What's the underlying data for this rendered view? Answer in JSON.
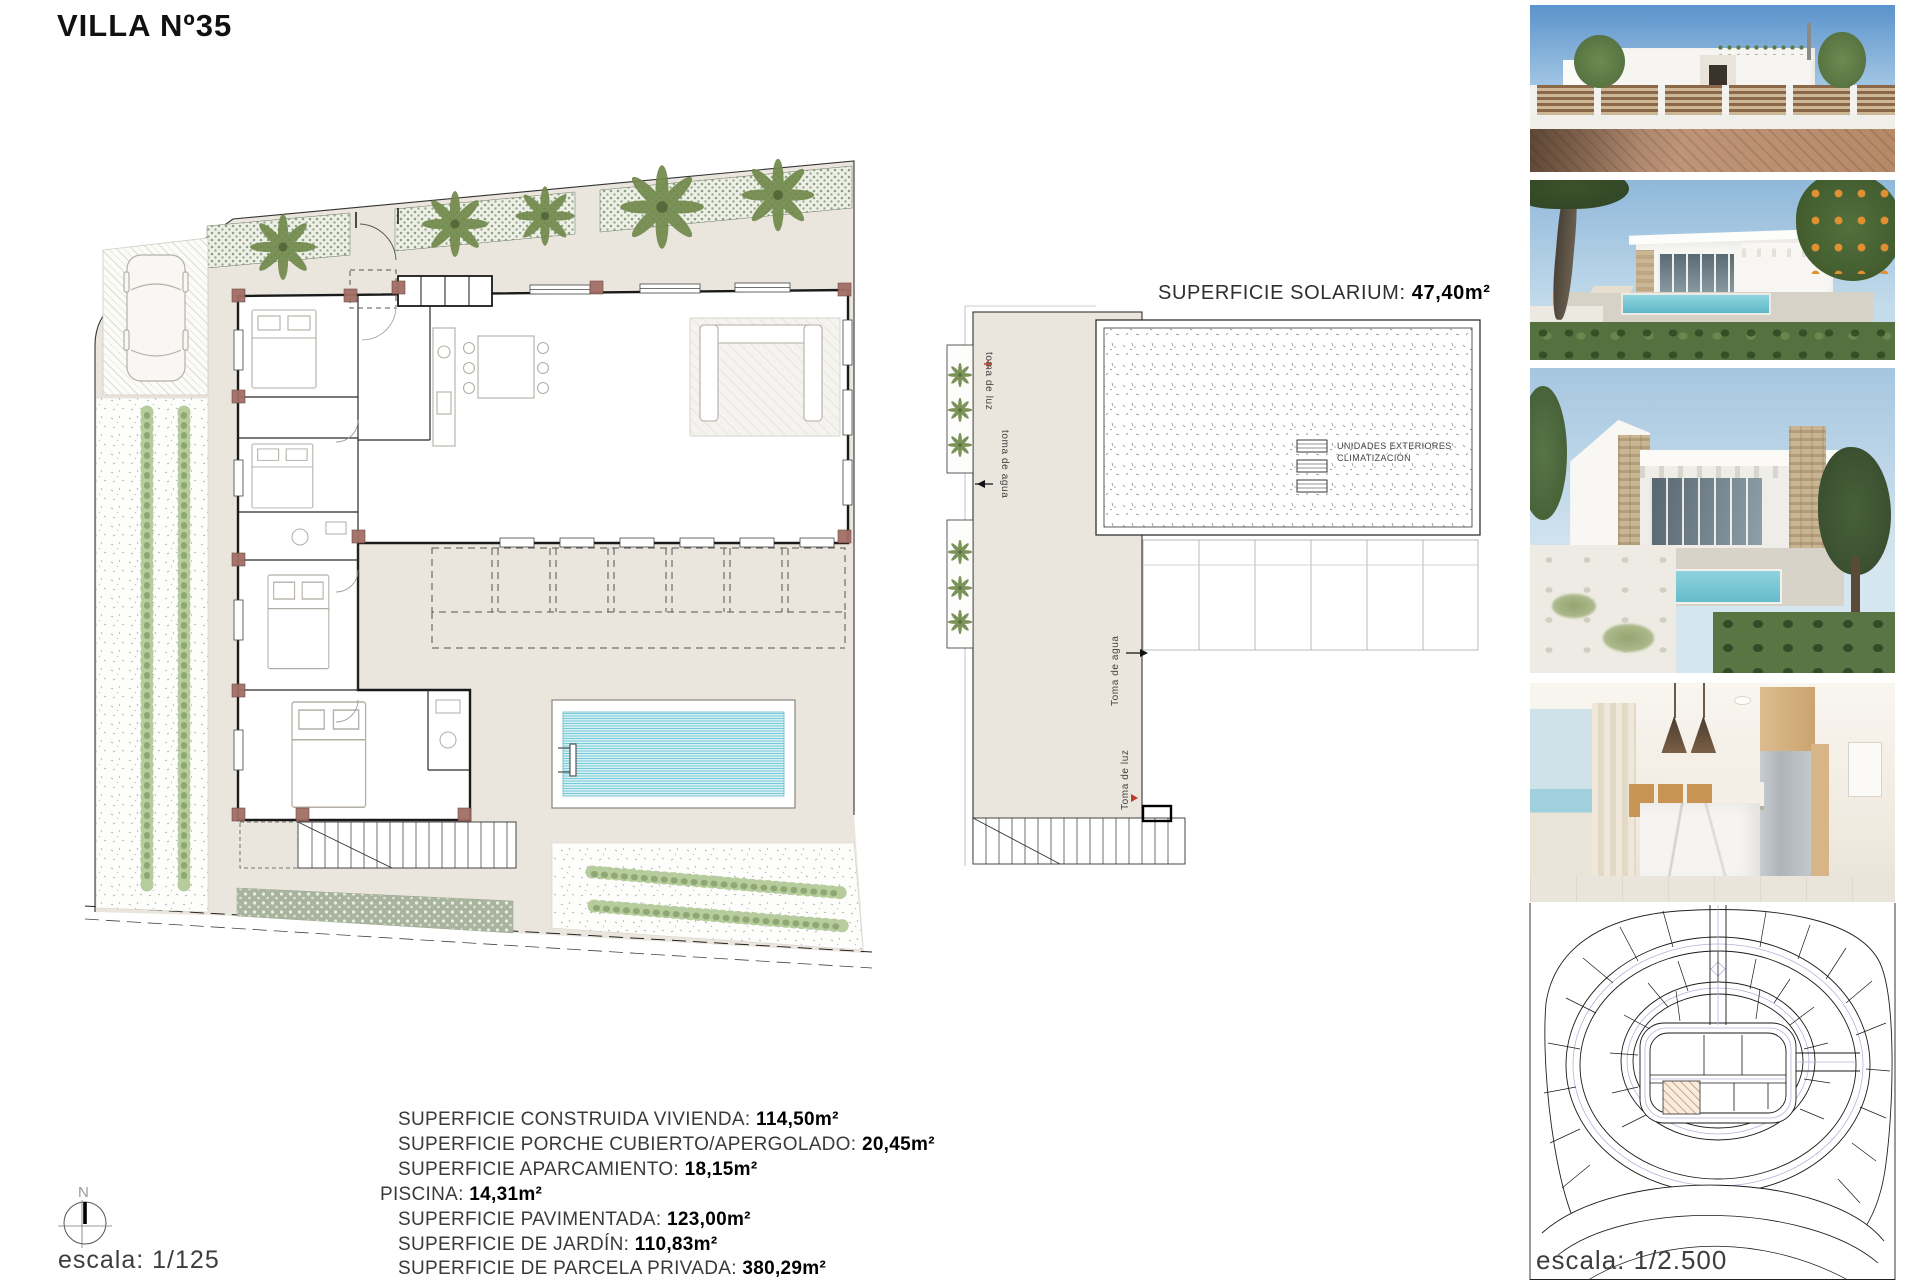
{
  "header": {
    "title": "VILLA Nº35"
  },
  "floor_plan": {
    "compass_label": "N",
    "scale_label": "escala: 1/125"
  },
  "solarium_plan": {
    "title_label": "SUPERFICIE SOLARIUM:",
    "title_value": "47,40m²",
    "label_toma_de_luz_top": "toma de luz",
    "label_toma_de_agua_top": "toma de agua",
    "label_toma_de_agua_side": "Toma de agua",
    "label_toma_de_luz_bottom": "Toma de luz",
    "ac_units_line1": "UNIDADES EXTERIORES",
    "ac_units_line2": "CLIMATIZACIÓN"
  },
  "areas_summary": {
    "items": [
      {
        "label": "SUPERFICIE CONSTRUIDA VIVIENDA:",
        "value": "114,50m²"
      },
      {
        "label": "SUPERFICIE PORCHE CUBIERTO/APERGOLADO:",
        "value": "20,45m²"
      },
      {
        "label": "SUPERFICIE APARCAMIENTO:",
        "value": "18,15m²"
      },
      {
        "label": "PISCINA:",
        "value": "14,31m²"
      },
      {
        "label": "SUPERFICIE PAVIMENTADA:",
        "value": "123,00m²"
      },
      {
        "label": "SUPERFICIE DE JARDÍN:",
        "value": "110,83m²"
      },
      {
        "label": "SUPERFICIE DE PARCELA PRIVADA:",
        "value": "380,29m²"
      }
    ]
  },
  "site_plan": {
    "scale_label": "escala: 1/2.500"
  },
  "colors": {
    "paving_beige": "#eae5dd",
    "plan_green": "#8ea186",
    "pool_water": "#74cad8",
    "site_lot_hatch": "#ad7a55",
    "wall_black": "#1a1a1a"
  }
}
